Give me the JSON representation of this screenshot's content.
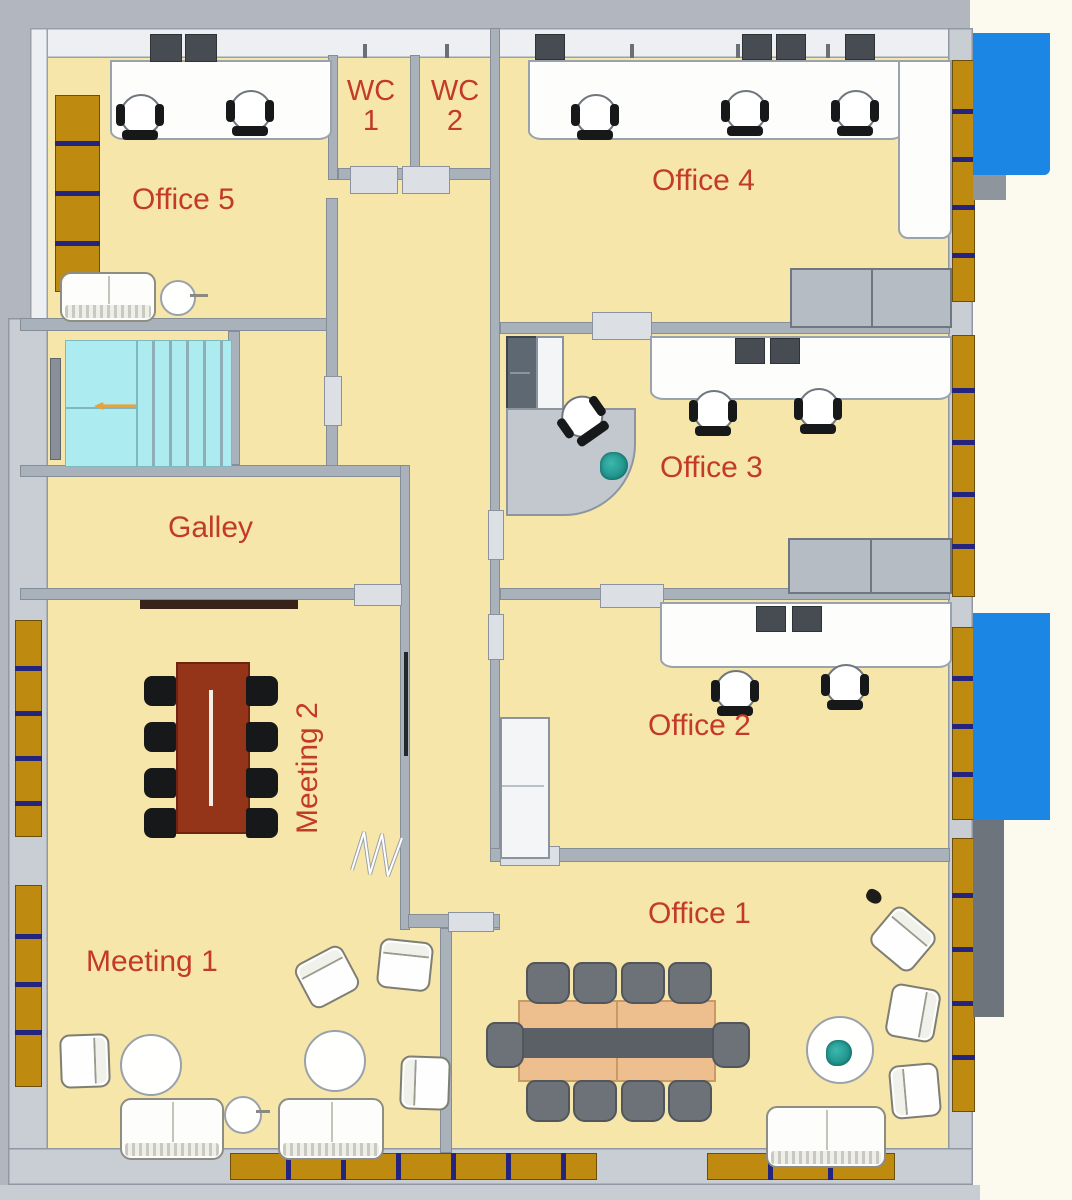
{
  "floorplan": {
    "rooms": {
      "office5": {
        "label": "Office 5"
      },
      "wc1": {
        "line1": "WC",
        "line2": "1"
      },
      "wc2": {
        "line1": "WC",
        "line2": "2"
      },
      "office4": {
        "label": "Office 4"
      },
      "office3": {
        "label": "Office 3"
      },
      "galley": {
        "label": "Galley"
      },
      "meeting2": {
        "label": "Meeting 2"
      },
      "office2": {
        "label": "Office 2"
      },
      "meeting1": {
        "label": "Meeting 1"
      },
      "office1": {
        "label": "Office 1"
      }
    },
    "colors": {
      "floor": "#F7E6A9",
      "wall": "#A9B1BB",
      "label_red": "#C23A28",
      "window_brown": "#BE8A10",
      "window_divider_navy": "#23247E",
      "stairs_cyan": "#ACECF0",
      "exterior_blue": "#1B86E3",
      "meeting_table_brown": "#943519",
      "conference_table_tan": "#EDBF8E",
      "chair_black": "#17181A",
      "chair_gray": "#6C7278"
    }
  }
}
